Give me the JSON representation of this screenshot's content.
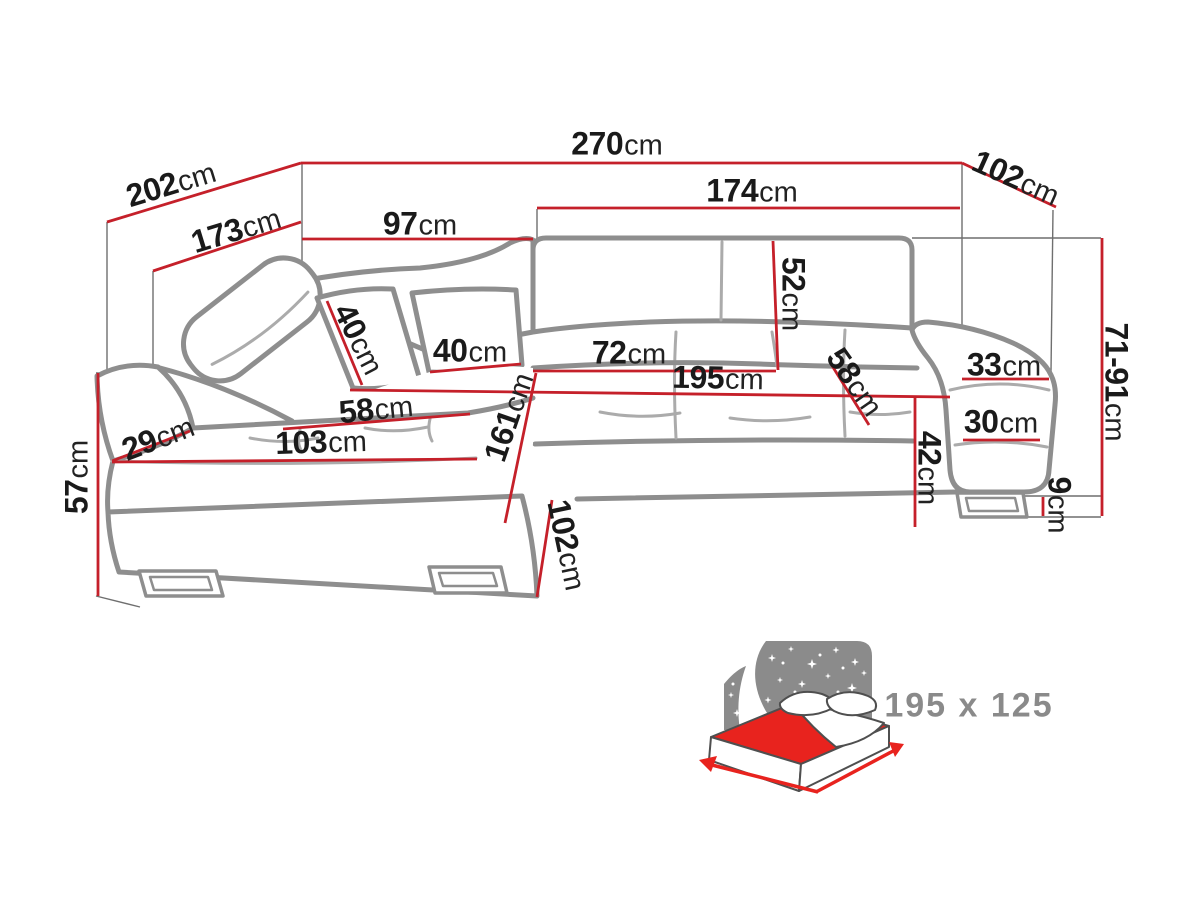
{
  "diagram": {
    "type": "corner-sofa-dimension-diagram",
    "unit": "cm",
    "accent_color": "#c5202a",
    "outline_color": "#8e8e8e",
    "text_color": "#1a1a1a",
    "dimensions": [
      {
        "value": "270",
        "unit": "cm",
        "x": 617,
        "y": 144,
        "r": 0,
        "line": [
          301,
          163,
          962,
          163
        ]
      },
      {
        "value": "202",
        "unit": "cm",
        "x": 171,
        "y": 184,
        "r": -17,
        "line": [
          107,
          222,
          301,
          163
        ]
      },
      {
        "value": "102",
        "unit": "cm",
        "x": 1016,
        "y": 178,
        "r": 24,
        "line": [
          962,
          163,
          1056,
          207
        ]
      },
      {
        "value": "173",
        "unit": "cm",
        "x": 236,
        "y": 230,
        "r": -17,
        "line": [
          153,
          271,
          301,
          222
        ]
      },
      {
        "value": "97",
        "unit": "cm",
        "x": 420,
        "y": 224,
        "r": 0,
        "line": [
          302,
          239,
          533,
          239
        ]
      },
      {
        "value": "174",
        "unit": "cm",
        "x": 752,
        "y": 191,
        "r": 0,
        "line": [
          537,
          208,
          960,
          208
        ]
      },
      {
        "value": "52",
        "unit": "cm",
        "x": 793,
        "y": 294,
        "r": 90,
        "line": [
          773,
          241,
          778,
          370
        ]
      },
      {
        "value": "40",
        "unit": "cm",
        "x": 359,
        "y": 339,
        "r": 63,
        "line": [
          327,
          301,
          362,
          385
        ]
      },
      {
        "value": "40",
        "unit": "cm",
        "x": 470,
        "y": 351,
        "r": 0,
        "line": [
          430,
          372,
          521,
          364
        ]
      },
      {
        "value": "72",
        "unit": "cm",
        "x": 629,
        "y": 353,
        "r": 0,
        "line": [
          533,
          371,
          776,
          371
        ]
      },
      {
        "value": "195",
        "unit": "cm",
        "x": 718,
        "y": 378,
        "r": 1,
        "line": [
          350,
          390,
          950,
          397
        ]
      },
      {
        "value": "58",
        "unit": "cm",
        "x": 376,
        "y": 409,
        "r": -6,
        "line": [
          283,
          429,
          470,
          414
        ]
      },
      {
        "value": "58",
        "unit": "cm",
        "x": 855,
        "y": 382,
        "r": 55,
        "line": [
          831,
          364,
          869,
          425
        ]
      },
      {
        "value": "29",
        "unit": "cm",
        "x": 158,
        "y": 438,
        "r": -21,
        "line": [
          112,
          461,
          190,
          431
        ]
      },
      {
        "value": "103",
        "unit": "cm",
        "x": 321,
        "y": 442,
        "r": -2,
        "line": [
          112,
          462,
          477,
          459
        ]
      },
      {
        "value": "161",
        "unit": "cm",
        "x": 509,
        "y": 417,
        "r": -71,
        "line": [
          536,
          373,
          505,
          523
        ]
      },
      {
        "value": "57",
        "unit": "cm",
        "x": 77,
        "y": 477,
        "r": -90,
        "line": [
          98,
          373,
          98,
          596
        ]
      },
      {
        "value": "102",
        "unit": "cm",
        "x": 567,
        "y": 545,
        "r": 78,
        "line": [
          552,
          500,
          537,
          597
        ]
      },
      {
        "value": "42",
        "unit": "cm",
        "x": 929,
        "y": 468,
        "r": 90,
        "line": [
          915,
          397,
          915,
          527
        ]
      },
      {
        "value": "33",
        "unit": "cm",
        "x": 1004,
        "y": 365,
        "r": 0,
        "line": [
          962,
          379,
          1049,
          379
        ]
      },
      {
        "value": "30",
        "unit": "cm",
        "x": 1001,
        "y": 422,
        "r": 0,
        "line": [
          963,
          440,
          1040,
          440
        ]
      },
      {
        "value": "9",
        "unit": "cm",
        "x": 1059,
        "y": 505,
        "r": 90,
        "line": [
          1043,
          497,
          1043,
          516
        ]
      },
      {
        "value": "71-91",
        "unit": "cm",
        "x": 1116,
        "y": 382,
        "r": 90,
        "line": [
          1102,
          238,
          1102,
          516
        ]
      }
    ],
    "bed_icon": {
      "caption": "195 x 125",
      "mattress_color": "#e8231e",
      "background_color": "#8b8b8b"
    }
  }
}
